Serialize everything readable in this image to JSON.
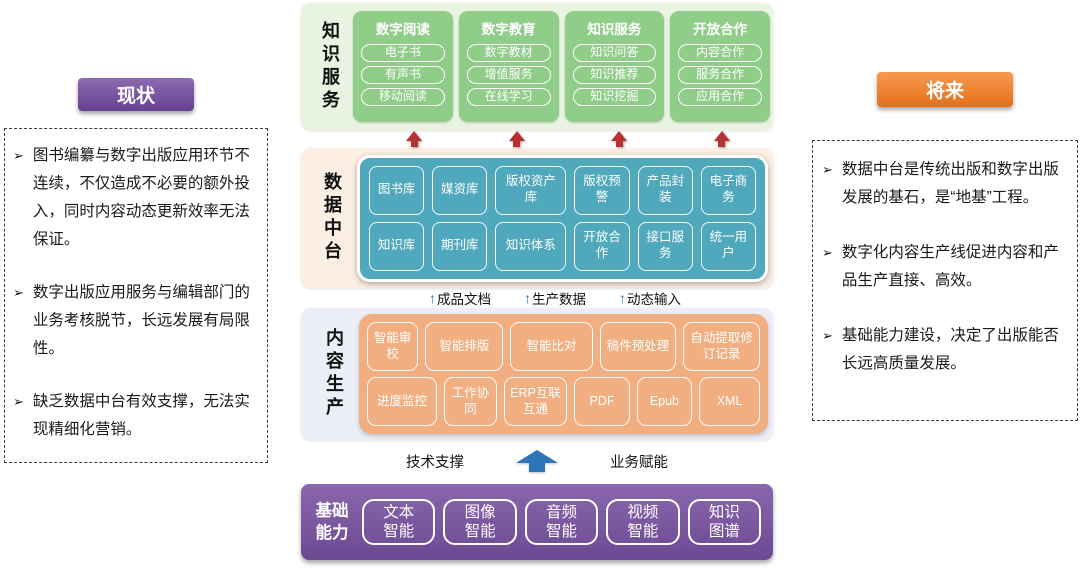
{
  "ui": {
    "bullet_char": "➢"
  },
  "colors": {
    "status_header": "#66418F",
    "future_header": "#E4701A",
    "knowledge_bg": "#E9F3E1",
    "knowledge_card": "#8FCD89",
    "platform_bg": "#FBEEE3",
    "platform_box": "#4FA8BC",
    "production_bg": "#ECEFF7",
    "production_box": "#F0AE81",
    "capability_box": "#6C4A93",
    "red_arrow": "#B5322F",
    "blue_arrow": "#2E75B6"
  },
  "left_panel": {
    "title": "现状",
    "bullets": [
      "图书编纂与数字出版应用环节不连续，不仅造成不必要的额外投入，同时内容动态更新效率无法保证。",
      "数字出版应用服务与编辑部门的业务考核脱节，长远发展有局限性。",
      "缺乏数据中台有效支撑，无法实现精细化营销。"
    ]
  },
  "right_panel": {
    "title": "将来",
    "bullets": [
      "数据中台是传统出版和数字出版发展的基石，是“地基”工程。",
      "数字化内容生产线促进内容和产品生产直接、高效。",
      "基础能力建设，决定了出版能否长远高质量发展。"
    ]
  },
  "knowledge_service": {
    "label": "知识服务",
    "cards": [
      {
        "title": "数字阅读",
        "items": [
          "电子书",
          "有声书",
          "移动阅读"
        ]
      },
      {
        "title": "数字教育",
        "items": [
          "数字教材",
          "增值服务",
          "在线学习"
        ]
      },
      {
        "title": "知识服务",
        "items": [
          "知识问答",
          "知识推荐",
          "知识挖掘"
        ]
      },
      {
        "title": "开放合作",
        "items": [
          "内容合作",
          "服务合作",
          "应用合作"
        ]
      }
    ]
  },
  "data_platform": {
    "label": "数据中台",
    "row1": [
      "图书库",
      "媒资库",
      "版权资产库",
      "版权预警",
      "产品封装",
      "电子商务"
    ],
    "row2": [
      "知识库",
      "期刊库",
      "知识体系",
      "开放合作",
      "接口服务",
      "统一用户"
    ]
  },
  "flow_labels": [
    "成品文档",
    "生产数据",
    "动态输入"
  ],
  "content_production": {
    "label": "内容生产",
    "row1": [
      "智能审校",
      "智能排版",
      "智能比对",
      "稿件预处理",
      "自动提取修订记录"
    ],
    "row2": [
      "进度监控",
      "工作协同",
      "ERP互联互通",
      "PDF",
      "Epub",
      "XML"
    ]
  },
  "support_row": {
    "left": "技术支撑",
    "right": "业务赋能"
  },
  "base_capability": {
    "label": "基础能力",
    "items": [
      "文本智能",
      "图像智能",
      "音频智能",
      "视频智能",
      "知识图谱"
    ]
  }
}
